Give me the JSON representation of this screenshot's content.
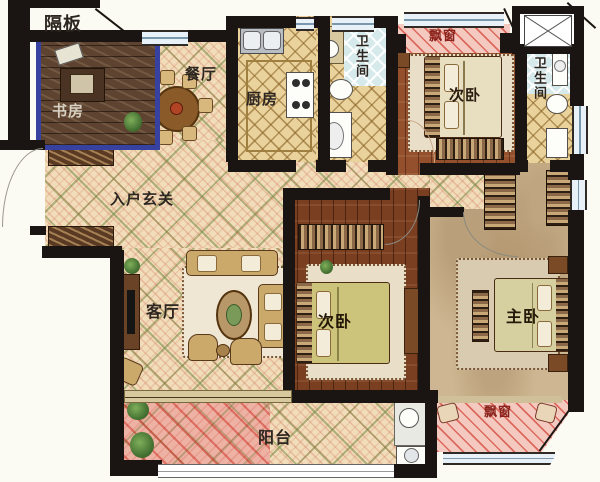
{
  "labels": {
    "partition": "隔板",
    "study": "书房",
    "dining": "餐厅",
    "kitchen": "厨房",
    "bath_top": "卫生间",
    "bath_right": "卫生间",
    "bay_top": "飘窗",
    "bed_top": "次卧",
    "entry": "入户玄关",
    "living": "客厅",
    "bed_mid": "次卧",
    "master": "主卧",
    "balcony": "阳台",
    "bay_bottom": "飘窗"
  },
  "colors": {
    "wall": "#1a1512",
    "ink": "#2e2620",
    "red": "#8a231b",
    "study_border": "#3742a0",
    "tile_beige": "#f1ddba",
    "tile_pink": "#eeb2a4",
    "bay_pink": "#f4c9c0",
    "bath_blue": "#d6eaec",
    "wood": "#94502c",
    "master_tan": "#cdb691"
  }
}
